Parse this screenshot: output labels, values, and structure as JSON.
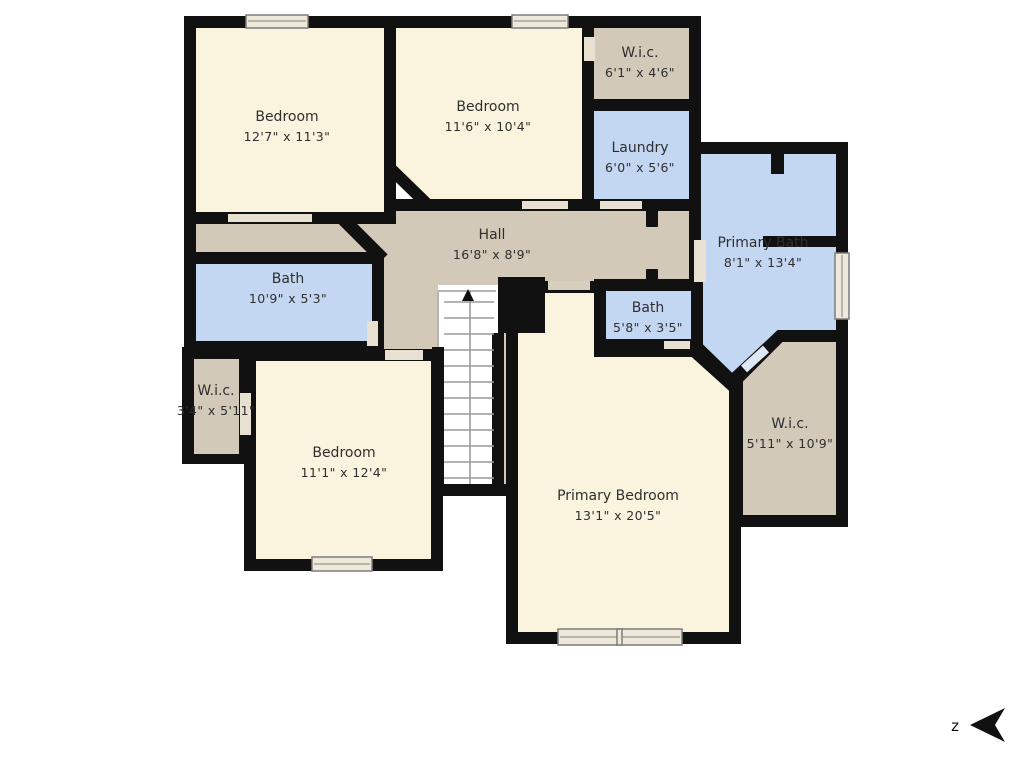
{
  "palette": {
    "wall": "#111111",
    "floor_cream": "#faf3dd",
    "floor_tan": "#d3c9b8",
    "floor_blue": "#c3d7f2",
    "outside": "#ffffff",
    "threshold": "#e8e1d1",
    "sill": "#d6cfbf",
    "window_fill": "#efe9db",
    "label_color": "#2f2f2f"
  },
  "rooms": [
    {
      "id": "hall",
      "name": "Hall",
      "dims": "16'8\" x 8'9\""
    },
    {
      "id": "bedroom-top-left",
      "name": "Bedroom",
      "dims": "12'7\" x 11'3\""
    },
    {
      "id": "bedroom-top-middle",
      "name": "Bedroom",
      "dims": "11'6\" x 10'4\""
    },
    {
      "id": "wic-top",
      "name": "W.i.c.",
      "dims": "6'1\" x 4'6\""
    },
    {
      "id": "laundry",
      "name": "Laundry",
      "dims": "6'0\" x 5'6\""
    },
    {
      "id": "primary-bath",
      "name": "Primary Bath",
      "dims": "8'1\" x 13'4\""
    },
    {
      "id": "bath-left",
      "name": "Bath",
      "dims": "10'9\" x 5'3\""
    },
    {
      "id": "bath-middle",
      "name": "Bath",
      "dims": "5'8\" x 3'5\""
    },
    {
      "id": "wic-left",
      "name": "W.i.c.",
      "dims": "3'4\" x 5'11\""
    },
    {
      "id": "bedroom-bottom-left",
      "name": "Bedroom",
      "dims": "11'1\" x 12'4\""
    },
    {
      "id": "primary-bedroom",
      "name": "Primary Bedroom",
      "dims": "13'1\" x 20'5\""
    },
    {
      "id": "wic-right",
      "name": "W.i.c.",
      "dims": "5'11\" x 10'9\""
    }
  ],
  "compass": {
    "label": "z"
  }
}
